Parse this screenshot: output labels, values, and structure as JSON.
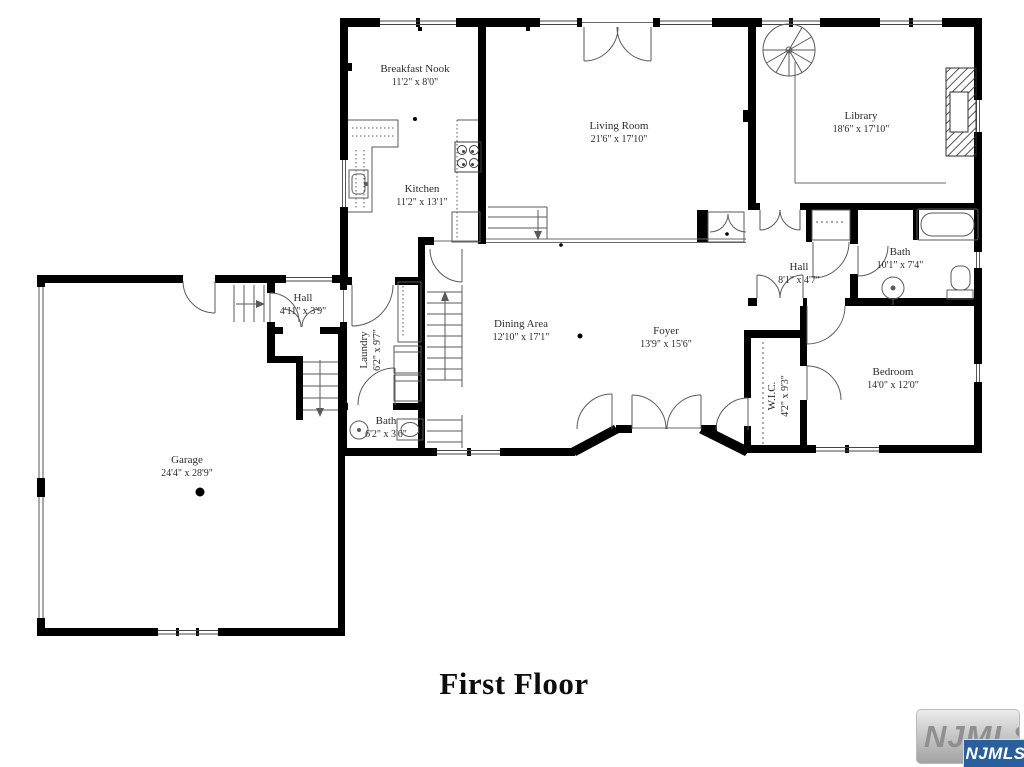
{
  "title": "First Floor",
  "colors": {
    "wall": "#000000",
    "thin_line": "#5a5a5a",
    "label_text": "#2b2b2b",
    "watermark_badge": "#2a5f9e",
    "background": "#ffffff"
  },
  "watermark": {
    "background_text": "NJMLS",
    "badge_text": "NJMLS"
  },
  "rooms": [
    {
      "id": "breakfast-nook",
      "name": "Breakfast Nook",
      "dims": "11'2\" x 8'0\""
    },
    {
      "id": "kitchen",
      "name": "Kitchen",
      "dims": "11'2\" x 13'1\""
    },
    {
      "id": "living-room",
      "name": "Living Room",
      "dims": "21'6\" x 17'10\""
    },
    {
      "id": "library",
      "name": "Library",
      "dims": "18'6\" x 17'10\""
    },
    {
      "id": "bath-main",
      "name": "Bath",
      "dims": "10'1\" x 7'4\""
    },
    {
      "id": "hall-upper",
      "name": "Hall",
      "dims": "8'1\" x 4'7\""
    },
    {
      "id": "bedroom",
      "name": "Bedroom",
      "dims": "14'0\" x 12'0\""
    },
    {
      "id": "wic",
      "name": "W.I.C.",
      "dims": "4'2\" x 9'3\""
    },
    {
      "id": "dining-area",
      "name": "Dining Area",
      "dims": "12'10\" x 17'1\""
    },
    {
      "id": "foyer",
      "name": "Foyer",
      "dims": "13'9\" x 15'6\""
    },
    {
      "id": "hall-lower",
      "name": "Hall",
      "dims": "4'11\" x 3'9\""
    },
    {
      "id": "laundry",
      "name": "Laundry",
      "dims": "6'2\" x 9'7\""
    },
    {
      "id": "bath-small",
      "name": "Bath",
      "dims": "6'2\" x 3'6\""
    },
    {
      "id": "garage",
      "name": "Garage",
      "dims": "24'4\" x 28'9\""
    }
  ]
}
